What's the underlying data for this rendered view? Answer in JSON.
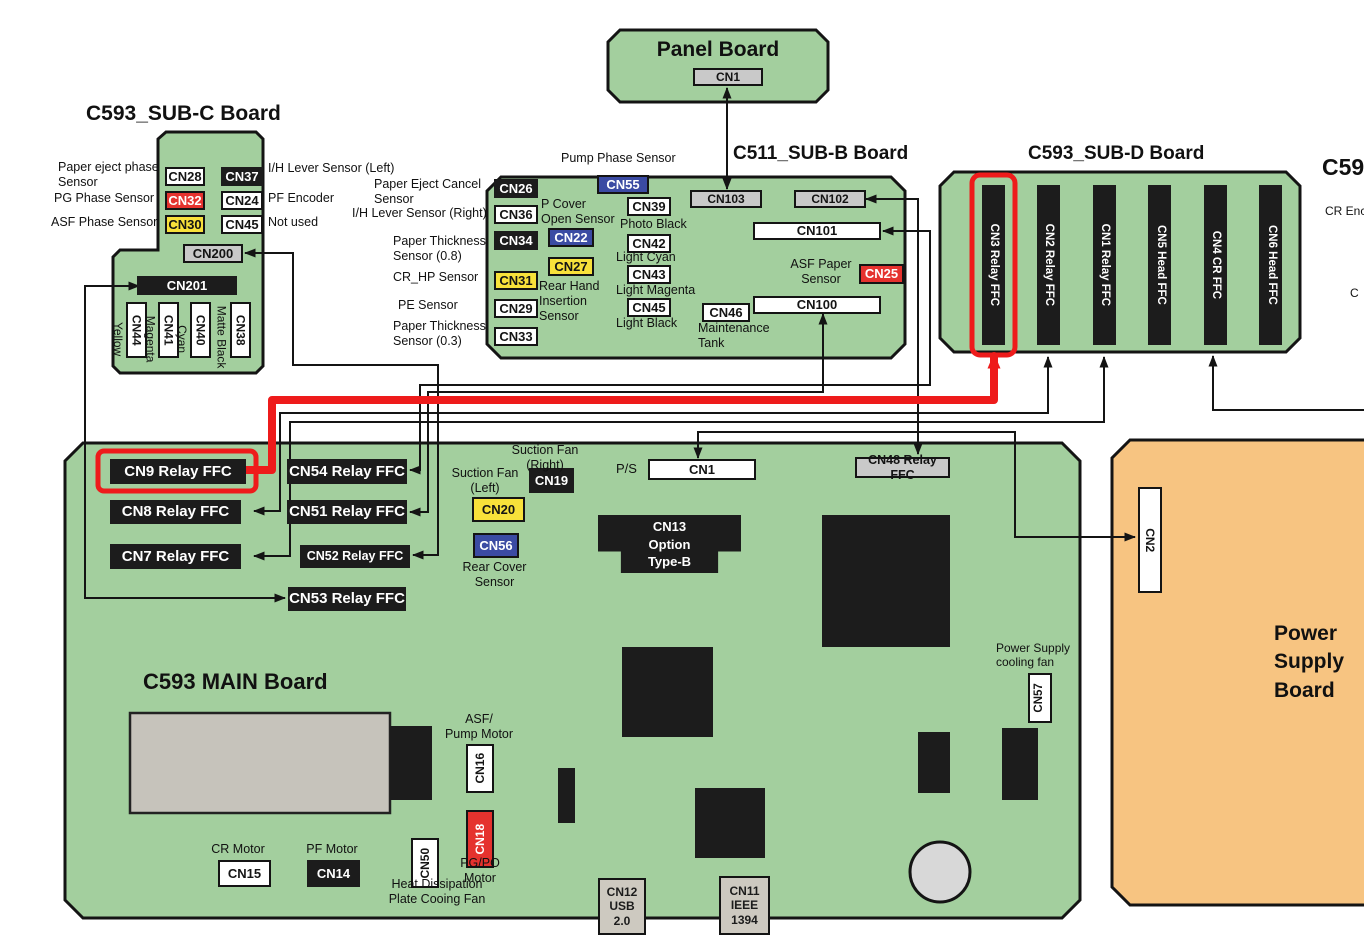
{
  "diagram": {
    "type": "printer service manual board interconnection diagram",
    "highlight_color": "#ee1b1b",
    "board_green": "#a3cf9e",
    "psu_orange": "#f7c481",
    "connections": [
      {
        "from": "Panel Board CN1",
        "to": "C511_SUB-B CN103",
        "highlighted": false
      },
      {
        "from": "C593_SUB-C CN200",
        "to": "MAIN CN52 Relay FFC",
        "highlighted": false
      },
      {
        "from": "C593_SUB-C CN201",
        "to": "MAIN CN53 Relay FFC",
        "highlighted": false
      },
      {
        "from": "C511_SUB-B CN101",
        "to": "MAIN CN54 Relay FFC",
        "highlighted": false
      },
      {
        "from": "C511_SUB-B CN100",
        "to": "MAIN CN51 Relay FFC",
        "highlighted": false
      },
      {
        "from": "C511_SUB-B CN102",
        "to": "MAIN CN48 Relay FFC",
        "highlighted": false
      },
      {
        "from": "MAIN CN9 Relay FFC",
        "to": "C593_SUB-D CN3 Relay FFC",
        "highlighted": true
      },
      {
        "from": "MAIN CN8 Relay FFC",
        "to": "C593_SUB-D CN2 Relay FFC",
        "highlighted": false
      },
      {
        "from": "MAIN CN7 Relay FFC",
        "to": "C593_SUB-D CN1 Relay FFC",
        "highlighted": false
      },
      {
        "from": "MAIN P/S CN1",
        "to": "Power Supply Board CN2",
        "highlighted": false
      },
      {
        "from": "C593_SUB-D CN4 CR FFC",
        "to": "board at right edge (cut off)",
        "highlighted": false
      }
    ]
  },
  "boards": {
    "panel": {
      "title": "Panel Board",
      "connectors": [
        {
          "label": "CN1",
          "color": "gray"
        }
      ],
      "labels": []
    },
    "sub_c": {
      "title": "C593_SUB-C Board",
      "connectors": [
        {
          "label": "CN28",
          "color": "white"
        },
        {
          "label": "CN37",
          "color": "black"
        },
        {
          "label": "CN32",
          "color": "red"
        },
        {
          "label": "CN24",
          "color": "white"
        },
        {
          "label": "CN30",
          "color": "yellow"
        },
        {
          "label": "CN45",
          "color": "white"
        },
        {
          "label": "CN200",
          "color": "gray"
        },
        {
          "label": "CN201",
          "color": "black"
        },
        {
          "label": "CN44",
          "color": "white"
        },
        {
          "label": "CN41",
          "color": "white"
        },
        {
          "label": "CN40",
          "color": "white"
        },
        {
          "label": "CN38",
          "color": "white"
        }
      ],
      "labels": [
        {
          "text": "Paper eject phase\nSensor"
        },
        {
          "text": "PG Phase Sensor"
        },
        {
          "text": "ASF Phase Sensor"
        },
        {
          "text": "I/H Lever Sensor (Left)"
        },
        {
          "text": "PF Encoder"
        },
        {
          "text": "Not used"
        },
        {
          "text": "Yellow"
        },
        {
          "text": "Magenta"
        },
        {
          "text": "Cyan"
        },
        {
          "text": "Matte Black"
        }
      ]
    },
    "sub_b": {
      "title": "C511_SUB-B Board",
      "connectors": [
        {
          "label": "CN26",
          "color": "black"
        },
        {
          "label": "CN36",
          "color": "white"
        },
        {
          "label": "CN34",
          "color": "black"
        },
        {
          "label": "CN31",
          "color": "yellow"
        },
        {
          "label": "CN29",
          "color": "white"
        },
        {
          "label": "CN33",
          "color": "white"
        },
        {
          "label": "CN55",
          "color": "blue"
        },
        {
          "label": "CN22",
          "color": "blue"
        },
        {
          "label": "CN27",
          "color": "yellow"
        },
        {
          "label": "CN39",
          "color": "white"
        },
        {
          "label": "CN42",
          "color": "white"
        },
        {
          "label": "CN43",
          "color": "white"
        },
        {
          "label": "CN45",
          "color": "white"
        },
        {
          "label": "CN46",
          "color": "white"
        },
        {
          "label": "CN103",
          "color": "gray"
        },
        {
          "label": "CN102",
          "color": "gray"
        },
        {
          "label": "CN101",
          "color": "white"
        },
        {
          "label": "CN25",
          "color": "red"
        },
        {
          "label": "CN100",
          "color": "white"
        }
      ],
      "labels": [
        {
          "text": "Pump Phase Sensor"
        },
        {
          "text": "Paper Eject Cancel\nSensor"
        },
        {
          "text": "I/H Lever Sensor (Right)"
        },
        {
          "text": "Paper Thickness\nSensor (0.8)"
        },
        {
          "text": "CR_HP Sensor"
        },
        {
          "text": "PE Sensor"
        },
        {
          "text": "Paper Thickness\nSensor (0.3)"
        },
        {
          "text": "P Cover\nOpen Sensor"
        },
        {
          "text": "Rear Hand\nInsertion\nSensor"
        },
        {
          "text": "Photo Black"
        },
        {
          "text": "Light Cyan"
        },
        {
          "text": "Light Magenta"
        },
        {
          "text": "Light Black"
        },
        {
          "text": "Maintenance\nTank"
        },
        {
          "text": "ASF Paper\nSensor"
        }
      ]
    },
    "sub_d": {
      "title": "C593_SUB-D Board",
      "connectors": [
        {
          "label": "CN3 Relay FFC",
          "color": "black",
          "highlighted": true
        },
        {
          "label": "CN2 Relay FFC",
          "color": "black"
        },
        {
          "label": "CN1 Relay FFC",
          "color": "black"
        },
        {
          "label": "CN5 Head FFC",
          "color": "black"
        },
        {
          "label": "CN4 CR FFC",
          "color": "black"
        },
        {
          "label": "CN6 Head FFC",
          "color": "black"
        }
      ],
      "labels": []
    },
    "main": {
      "title": "C593 MAIN Board",
      "connectors": [
        {
          "label": "CN9 Relay FFC",
          "color": "black",
          "highlighted": true
        },
        {
          "label": "CN54 Relay FFC",
          "color": "black"
        },
        {
          "label": "CN8 Relay FFC",
          "color": "black"
        },
        {
          "label": "CN51 Relay FFC",
          "color": "black"
        },
        {
          "label": "CN7 Relay FFC",
          "color": "black"
        },
        {
          "label": "CN52 Relay FFC",
          "color": "black"
        },
        {
          "label": "CN53 Relay FFC",
          "color": "black"
        },
        {
          "label": "CN48 Relay FFC",
          "color": "gray"
        },
        {
          "label": "CN19",
          "color": "black"
        },
        {
          "label": "CN20",
          "color": "yellow"
        },
        {
          "label": "CN56",
          "color": "blue"
        },
        {
          "label": "CN1",
          "color": "white"
        },
        {
          "label": "CN13\nOption\nType-B",
          "color": "black"
        },
        {
          "label": "CN16",
          "color": "white"
        },
        {
          "label": "CN18",
          "color": "red"
        },
        {
          "label": "CN50",
          "color": "white"
        },
        {
          "label": "CN15",
          "color": "white"
        },
        {
          "label": "CN14",
          "color": "black"
        },
        {
          "label": "CN57",
          "color": "white"
        },
        {
          "label": "CN12\nUSB\n2.0",
          "color": "tan"
        },
        {
          "label": "CN11\nIEEE\n1394",
          "color": "tan"
        }
      ],
      "labels": [
        {
          "text": "Suction Fan\n(Right)"
        },
        {
          "text": "Suction Fan\n(Left)"
        },
        {
          "text": "Rear Cover\nSensor"
        },
        {
          "text": "P/S"
        },
        {
          "text": "Power Supply\ncooling fan"
        },
        {
          "text": "ASF/\nPump Motor"
        },
        {
          "text": "PG/PO\nMotor"
        },
        {
          "text": "CR Motor"
        },
        {
          "text": "PF Motor"
        },
        {
          "text": "Heat Dissipation\nPlate Cooing Fan"
        }
      ]
    },
    "psu": {
      "title": "Power Supply Board",
      "connectors": [
        {
          "label": "CN2",
          "color": "white"
        }
      ],
      "labels": []
    },
    "cutoff_right": {
      "title": "C59",
      "labels": [
        {
          "text": "CR Enc"
        },
        {
          "text": "C"
        }
      ]
    }
  }
}
